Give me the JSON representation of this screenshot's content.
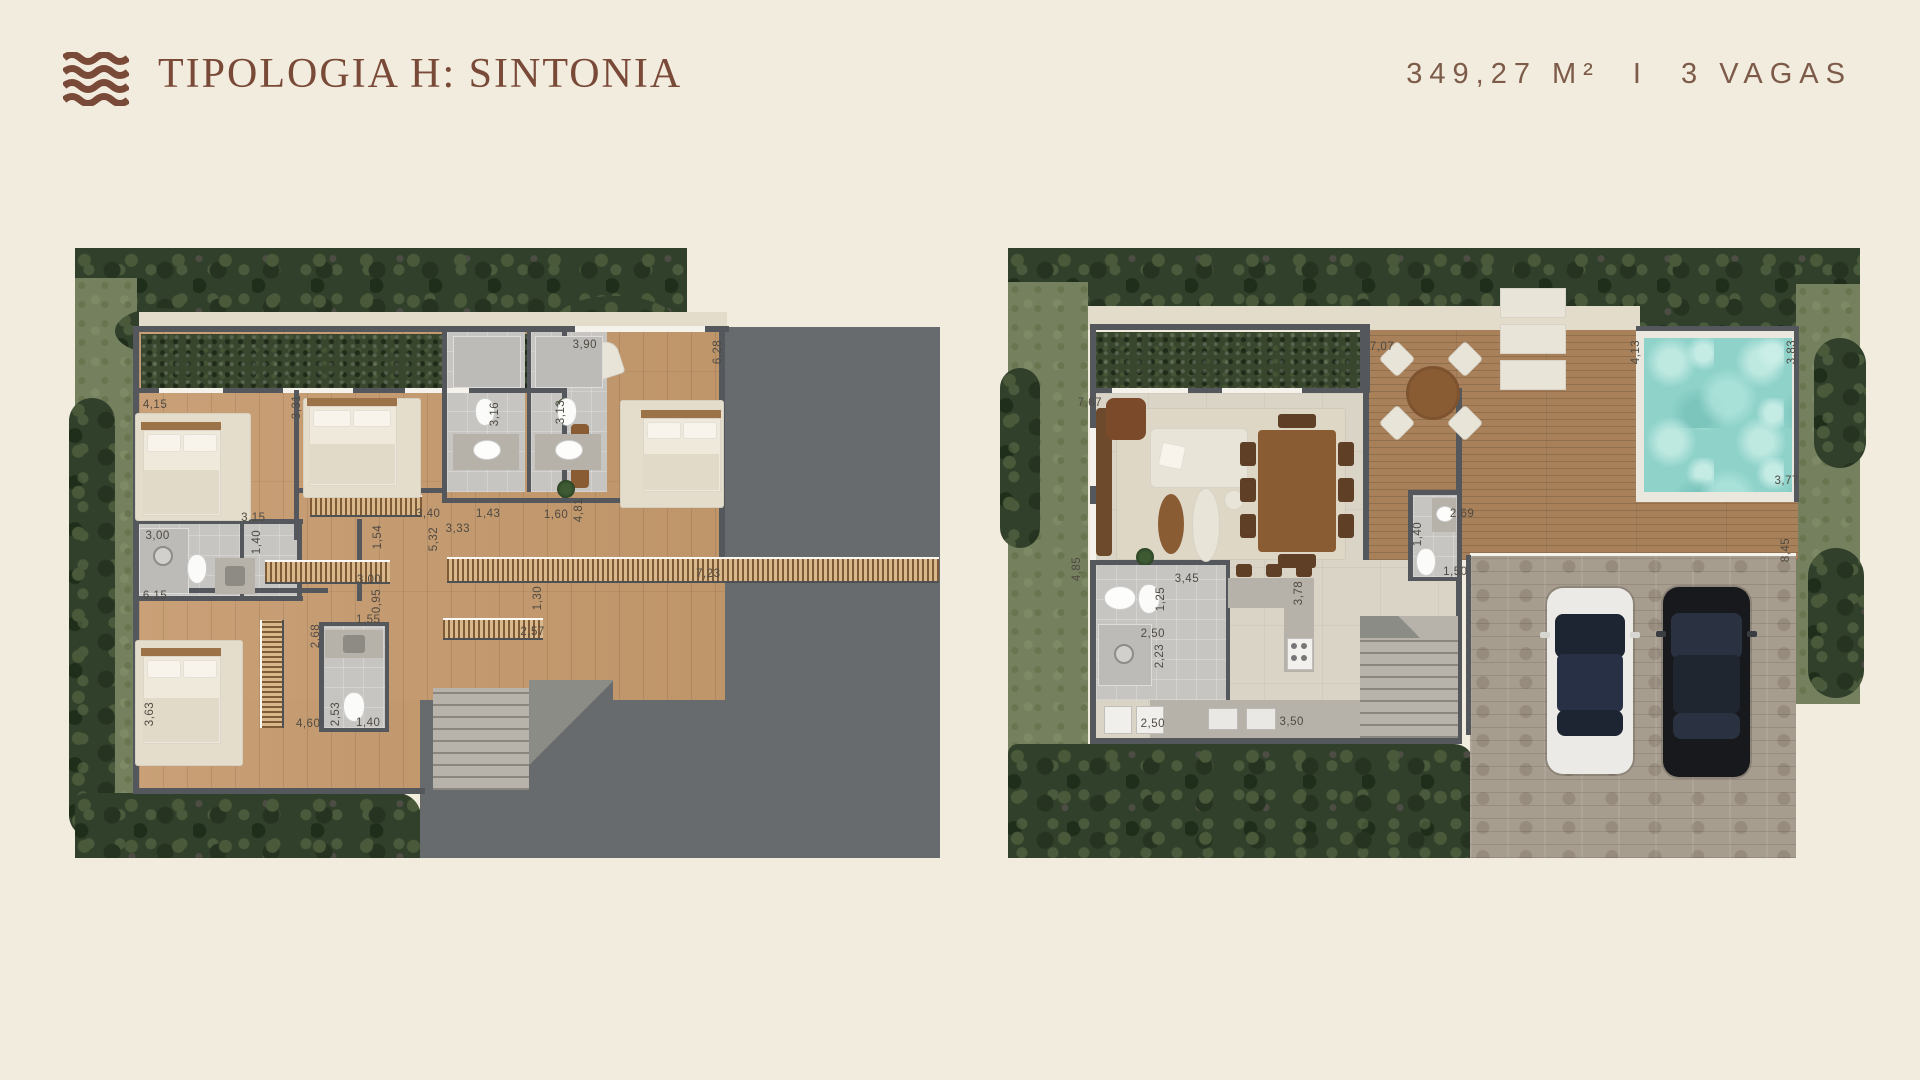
{
  "header": {
    "title": "TIPOLOGIA H: SINTONIA",
    "area": "349,27 M²",
    "divider": "I",
    "parking": "3 VAGAS",
    "brand_color": "#7a4a38"
  },
  "plans": {
    "left": {
      "name": "pavimento-superior",
      "labels": [
        {
          "t": "4,15",
          "x": 9.2,
          "y": 25.7,
          "r": 0
        },
        {
          "t": "3,31",
          "x": 25.5,
          "y": 26.1,
          "r": 1
        },
        {
          "t": "3,90",
          "x": 58.6,
          "y": 15.9,
          "r": 0
        },
        {
          "t": "6,28",
          "x": 73.9,
          "y": 17.0,
          "r": 1
        },
        {
          "t": "3,16",
          "x": 48.3,
          "y": 27.2,
          "r": 1
        },
        {
          "t": "3,13",
          "x": 55.9,
          "y": 26.9,
          "r": 1
        },
        {
          "t": "3,15",
          "x": 20.5,
          "y": 44.3,
          "r": 0
        },
        {
          "t": "1,40",
          "x": 20.9,
          "y": 48.2,
          "r": 1
        },
        {
          "t": "3,00",
          "x": 9.5,
          "y": 47.2,
          "r": 0
        },
        {
          "t": "3,40",
          "x": 40.6,
          "y": 43.6,
          "r": 0
        },
        {
          "t": "1,54",
          "x": 34.8,
          "y": 47.4,
          "r": 1
        },
        {
          "t": "5,32",
          "x": 41.3,
          "y": 47.7,
          "r": 1
        },
        {
          "t": "3,33",
          "x": 44.0,
          "y": 46.1,
          "r": 0
        },
        {
          "t": "1,43",
          "x": 47.5,
          "y": 43.6,
          "r": 0
        },
        {
          "t": "1,60",
          "x": 55.3,
          "y": 43.8,
          "r": 0
        },
        {
          "t": "4,81",
          "x": 57.9,
          "y": 43.0,
          "r": 1
        },
        {
          "t": "3,00",
          "x": 33.8,
          "y": 54.4,
          "r": 0
        },
        {
          "t": "0,95",
          "x": 34.7,
          "y": 57.9,
          "r": 1
        },
        {
          "t": "6,15",
          "x": 9.2,
          "y": 57.0,
          "r": 0
        },
        {
          "t": "1,55",
          "x": 33.7,
          "y": 61.0,
          "r": 0
        },
        {
          "t": "2,68",
          "x": 27.7,
          "y": 63.6,
          "r": 1
        },
        {
          "t": "1,30",
          "x": 53.2,
          "y": 57.4,
          "r": 1
        },
        {
          "t": "2,57",
          "x": 52.6,
          "y": 63.0,
          "r": 0
        },
        {
          "t": "3,63",
          "x": 8.6,
          "y": 76.4,
          "r": 1
        },
        {
          "t": "4,60",
          "x": 26.8,
          "y": 78.0,
          "r": 0
        },
        {
          "t": "2,53",
          "x": 30.0,
          "y": 76.4,
          "r": 1
        },
        {
          "t": "1,40",
          "x": 33.7,
          "y": 77.9,
          "r": 0
        },
        {
          "t": "7,23",
          "x": 72.8,
          "y": 53.4,
          "r": 0
        }
      ]
    },
    "right": {
      "name": "pavimento-terreo",
      "labels": [
        {
          "t": "7,67",
          "x": 9.6,
          "y": 25.4,
          "r": 0
        },
        {
          "t": "7,07",
          "x": 43.9,
          "y": 16.2,
          "r": 0
        },
        {
          "t": "4,13",
          "x": 73.7,
          "y": 17.0,
          "r": 1
        },
        {
          "t": "3,83",
          "x": 92.0,
          "y": 17.0,
          "r": 1
        },
        {
          "t": "3,77",
          "x": 91.4,
          "y": 38.2,
          "r": 0
        },
        {
          "t": "8,45",
          "x": 91.3,
          "y": 49.5,
          "r": 1
        },
        {
          "t": "4,85",
          "x": 8.1,
          "y": 52.6,
          "r": 1
        },
        {
          "t": "3,45",
          "x": 21.0,
          "y": 54.3,
          "r": 0
        },
        {
          "t": "1,25",
          "x": 18.0,
          "y": 57.5,
          "r": 1
        },
        {
          "t": "2,50",
          "x": 17.0,
          "y": 63.3,
          "r": 0
        },
        {
          "t": "2,23",
          "x": 17.8,
          "y": 66.9,
          "r": 1
        },
        {
          "t": "2,50",
          "x": 17.0,
          "y": 78.0,
          "r": 0
        },
        {
          "t": "3,50",
          "x": 33.3,
          "y": 77.7,
          "r": 0
        },
        {
          "t": "3,78",
          "x": 34.2,
          "y": 56.6,
          "r": 1
        },
        {
          "t": "2,69",
          "x": 53.3,
          "y": 43.6,
          "r": 0
        },
        {
          "t": "1,40",
          "x": 48.1,
          "y": 46.9,
          "r": 1
        },
        {
          "t": "1,50",
          "x": 52.5,
          "y": 53.1,
          "r": 0
        }
      ]
    }
  }
}
